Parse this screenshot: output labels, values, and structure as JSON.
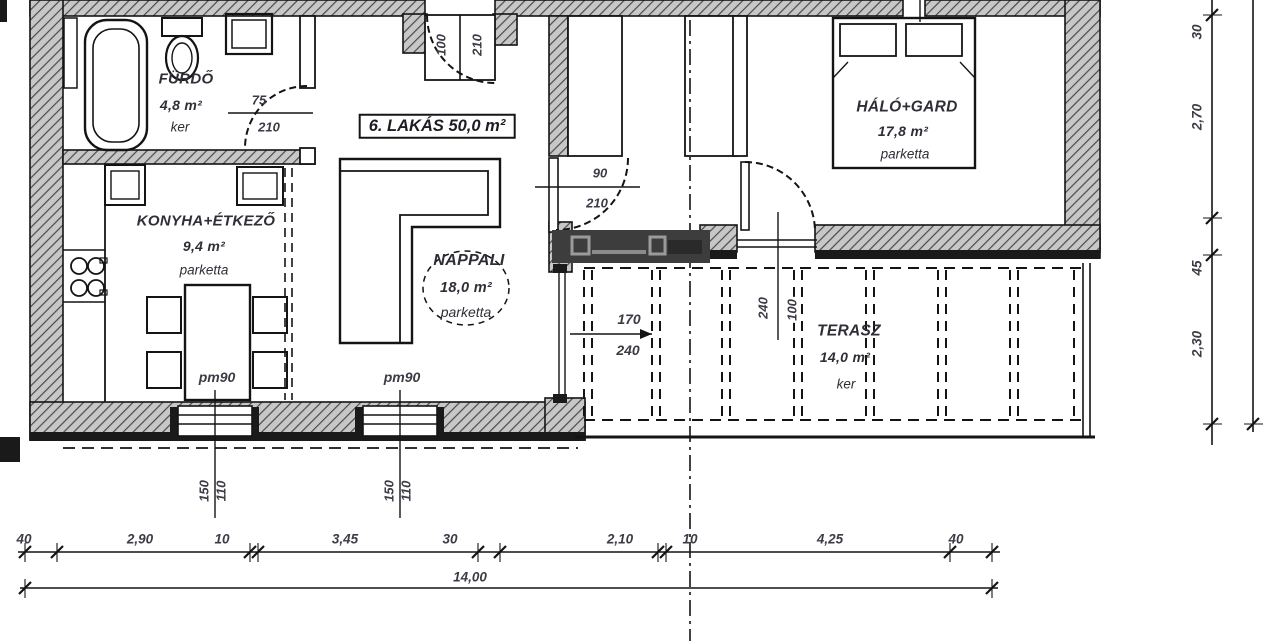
{
  "plan": {
    "unit_label": "6. LAKÁS 50,0 m²",
    "rooms": {
      "furdo": {
        "name": "FÜRDŐ",
        "area": "4,8 m²",
        "floor": "ker"
      },
      "konyha": {
        "name": "KONYHA+ÉTKEZŐ",
        "area": "9,4 m²",
        "floor": "parketta"
      },
      "nappali": {
        "name": "NAPPALI",
        "area": "18,0 m²",
        "floor": "parketta"
      },
      "halo": {
        "name": "HÁLÓ+GARD",
        "area": "17,8 m²",
        "floor": "parketta"
      },
      "terasz": {
        "name": "TERASZ",
        "area": "14,0 m²",
        "floor": "ker"
      }
    },
    "openings": {
      "entrance_door": {
        "width": "100",
        "height": "210"
      },
      "bathroom_door": {
        "width": "75",
        "height": "210"
      },
      "hall_door": {
        "width": "90",
        "height": "210"
      },
      "terrace_door": {
        "width": "100",
        "height": "240"
      },
      "living_glass": {
        "width": "170",
        "height": "240"
      },
      "window": {
        "parapet": "pm90",
        "width": "110",
        "height": "150"
      }
    }
  },
  "dimensions": {
    "bottom": [
      "40",
      "2,90",
      "10",
      "3,45",
      "30",
      "2,10",
      "10",
      "4,25",
      "40"
    ],
    "bottom_total": "14,00",
    "right": [
      "30",
      "2,70",
      "45",
      "2,30"
    ]
  },
  "colors": {
    "line": "#141414",
    "hatch_fill": "#c7c7c7",
    "hatch_stroke": "#4a4a4a",
    "watermark": "#3d3d3d"
  }
}
